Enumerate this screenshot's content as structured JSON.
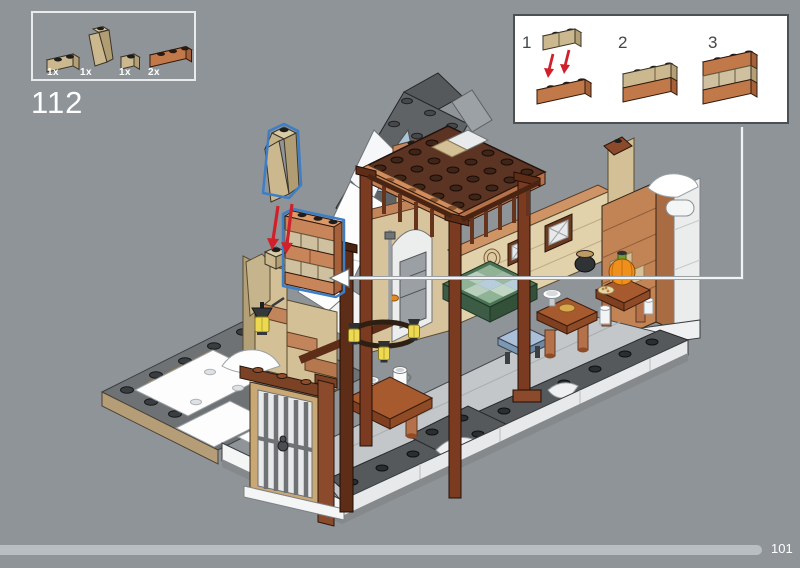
{
  "step": {
    "number": "112"
  },
  "parts_panel": {
    "parts": [
      {
        "name": "brick-1x2-tan",
        "count": "1x"
      },
      {
        "name": "slope-75-1x2x3-tan",
        "count": "1x"
      },
      {
        "name": "brick-1x1-tan",
        "count": "1x"
      },
      {
        "name": "brick-1x3-medium-nougat",
        "count": "2x"
      }
    ]
  },
  "subassembly": {
    "steps": [
      "1",
      "2",
      "3"
    ]
  },
  "footer": {
    "page_number": "101"
  },
  "colors": {
    "background": "#8e9498",
    "tan_top": "#d9cba6",
    "tan_front": "#cbb88e",
    "tan_side": "#b3a076",
    "nougat_top": "#d28d5e",
    "nougat_front": "#c2794a",
    "nougat_side": "#a5613a",
    "reddish_brown": "#7a3b20",
    "dark_brown_loft": "#5b3423",
    "roof_gray": "#5f6366",
    "snow_white": "#fdfdfd",
    "highlight_blue": "#3d7ec7",
    "arrow_red": "#d0212a",
    "progress_bar": "#b9bec2"
  }
}
